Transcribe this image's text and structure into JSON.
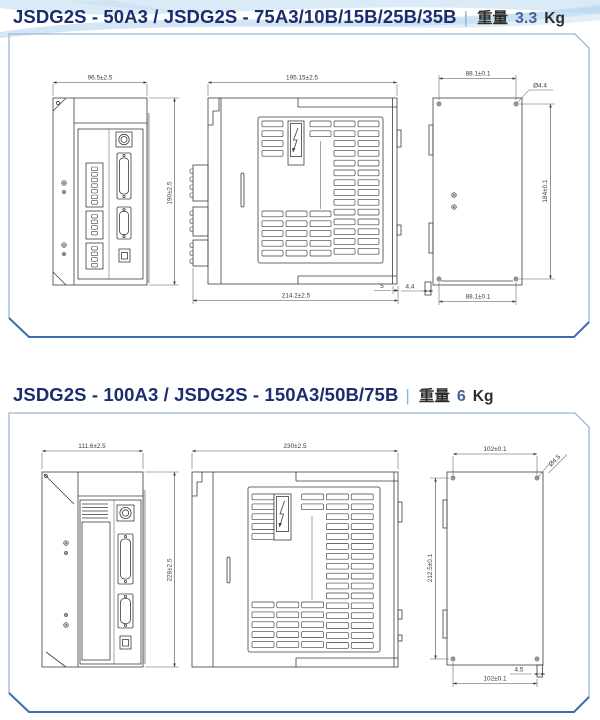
{
  "colors": {
    "title_text": "#1c2d6e",
    "weight_value": "#44639e",
    "panel_border": "#9db6d6",
    "panel_border_accent": "#3e6cb0",
    "drawing_line": "#3d3d3d",
    "wave_blue": "#b9d7ec"
  },
  "sections": [
    {
      "title": "JSDG2S - 50A3 / JSDG2S - 75A3/10B/15B/25B/35B",
      "divider": "|",
      "weight_label": "重量",
      "weight_value": "3.3",
      "weight_unit": "Kg",
      "dims": {
        "front_width": "96.5±2.5",
        "front_height": "190±2.5",
        "side_width": "195.15±2.5",
        "side_depth_overall": "214.2±2.5",
        "side_offset": "5",
        "back_hole": "Ø4.4",
        "back_top_width": "88.1±0.1",
        "back_height": "184±0.1",
        "back_bottom_width": "88.1±0.1",
        "back_tab": "4.4"
      }
    },
    {
      "title": "JSDG2S - 100A3 / JSDG2S - 150A3/50B/75B",
      "divider": "|",
      "weight_label": "重量",
      "weight_value": "6",
      "weight_unit": "Kg",
      "dims": {
        "front_width": "111.6±2.5",
        "front_height": "228±2.5",
        "side_width": "230±2.5",
        "back_hole": "Ø4.5",
        "back_top_width": "102±0.1",
        "back_height": "212.5±0.1",
        "back_bottom_width": "102±0.1",
        "back_tab": "4.5"
      }
    }
  ]
}
